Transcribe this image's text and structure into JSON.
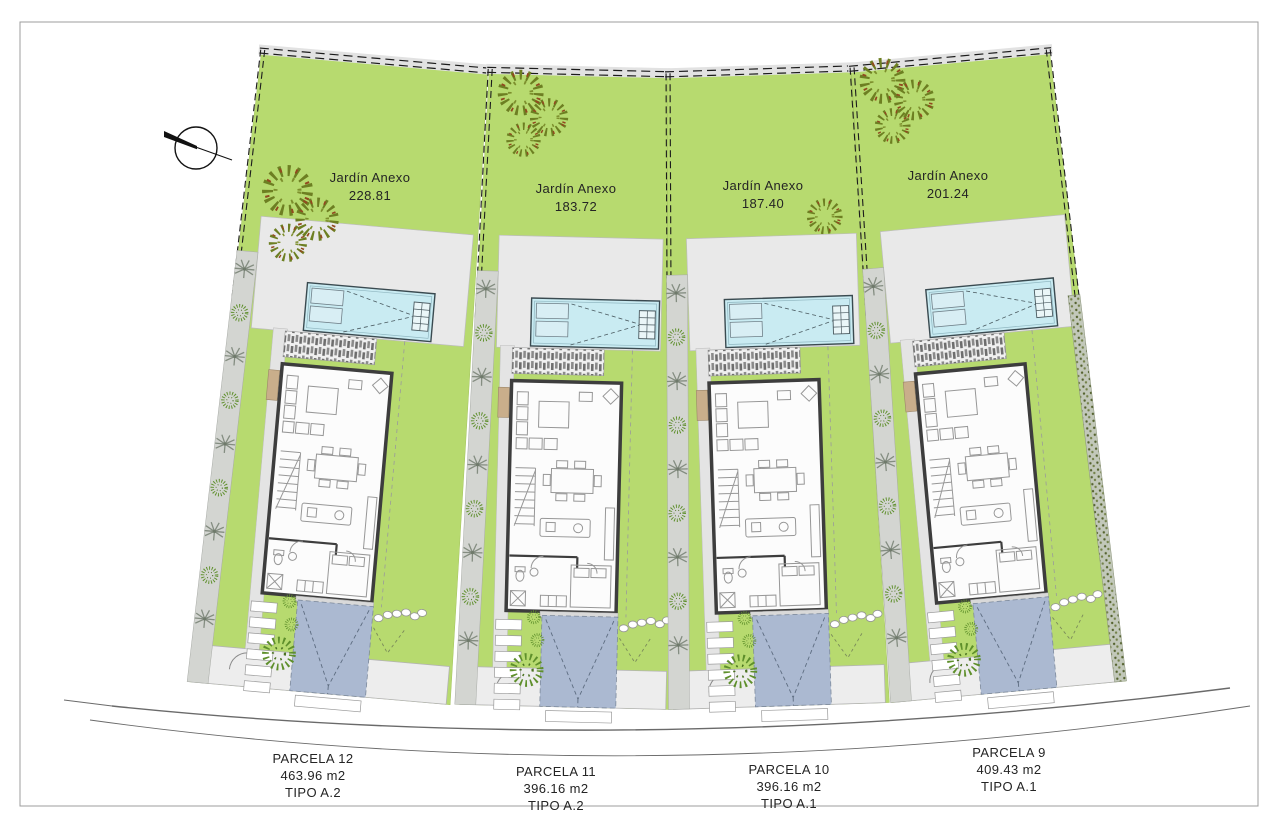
{
  "page": {
    "background": "#ffffff",
    "border_color": "#9c9c9c"
  },
  "compass": {
    "name": "north-arrow"
  },
  "colors": {
    "grass": "#b7da6f",
    "pool": "#c9ebf2",
    "pool_lounger": "#d8eef4",
    "terrace": "#e9e9e9",
    "driveway": "#abb9d1",
    "path_gray": "#d3d5d1",
    "house_wall": "#3d3d3d",
    "planter_tan": "#c9ae8b",
    "road": "#6a6a6a"
  },
  "site": {
    "garden_label": "Jardín Anexo",
    "parcels": [
      {
        "label": "PARCELA 12",
        "garden_area": "228.81",
        "area": "463.96 m2",
        "tipo": "TIPO A.2"
      },
      {
        "label": "PARCELA 11",
        "garden_area": "183.72",
        "area": "396.16 m2",
        "tipo": "TIPO A.2"
      },
      {
        "label": "PARCELA 10",
        "garden_area": "187.40",
        "area": "396.16 m2",
        "tipo": "TIPO A.1"
      },
      {
        "label": "PARCELA 9",
        "garden_area": "201.24",
        "area": "409.43 m2",
        "tipo": "TIPO A.1"
      }
    ]
  }
}
